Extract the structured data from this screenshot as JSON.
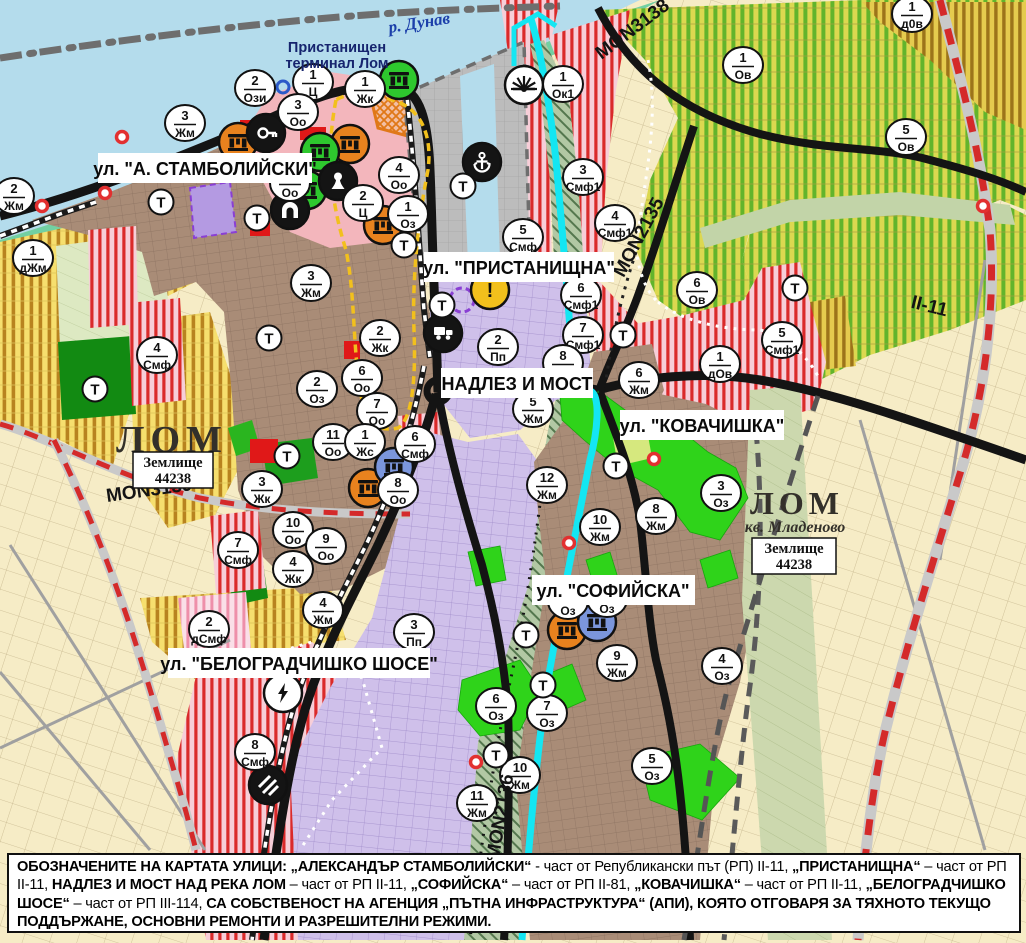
{
  "map": {
    "labels": {
      "river": "р. Дунав",
      "terminal_line1": "Пристанищен",
      "terminal_line2": "терминал Лом",
      "street_stamboliyski": "ул. \"А. СТАМБОЛИЙСКИ\"",
      "street_pristanishtna": "ул. \"ПРИСТАНИЩНА\"",
      "nadlez": "НАДЛЕЗ И МОСТ",
      "street_kovachishka": "ул. \"КОВАЧИШКА\"",
      "street_sofiyska": "ул. \"СОФИЙСКА\"",
      "street_belogradchishko": "ул. \"БЕЛОГРАДЧИШКО ШОСЕ\"",
      "town_west": "ЛОМ",
      "town_east": "ЛОМ",
      "district_east": "кв. Младеново",
      "landplot_line1": "Землище",
      "landplot_line2": "44238",
      "road_mon3138": "MON3138",
      "road_mon2135": "MON2135",
      "road_mon3139": "MON3139",
      "road_mon2136": "MON2136",
      "road_ii11": "II-11"
    },
    "colors": {
      "water": "#b4dcec",
      "shore_green": "#72d0a2",
      "town_brown": "#a98c77",
      "cream": "#f6ecc6",
      "zone_red_stripe": "#da2a2a",
      "vineyard_green": "#62b42c",
      "yellow_zone": "#f6df6e",
      "purple_zone": "#cfc0ea",
      "port_gray": "#bcbcbc",
      "river_cyan": "#14e6f2",
      "road_black": "#141414",
      "road_red_dash": "#d42a2a",
      "marker_fill": "#ffffff",
      "marker_stroke": "#111111",
      "ruins_orange": "#e8821e",
      "ruins_green": "#2ec82e",
      "ruins_blue": "#7b96dc",
      "warn_yellow": "#f2c01c",
      "bright_green": "#2fd31a",
      "dark_green": "#128a12"
    },
    "zone_markers": [
      {
        "x": 14,
        "y": 196,
        "num": "2",
        "code": "Жм"
      },
      {
        "x": 33,
        "y": 258,
        "num": "1",
        "code": "дЖм"
      },
      {
        "x": 185,
        "y": 123,
        "num": "3",
        "code": "Жм"
      },
      {
        "x": 255,
        "y": 88,
        "num": "2",
        "code": "Ози"
      },
      {
        "x": 313,
        "y": 82,
        "num": "1",
        "code": "Ц"
      },
      {
        "x": 298,
        "y": 112,
        "num": "3",
        "code": "Оо"
      },
      {
        "x": 365,
        "y": 89,
        "num": "1",
        "code": "Жк"
      },
      {
        "x": 399,
        "y": 175,
        "num": "4",
        "code": "Оо"
      },
      {
        "x": 363,
        "y": 203,
        "num": "2",
        "code": "Ц"
      },
      {
        "x": 408,
        "y": 214,
        "num": "1",
        "code": "Оз"
      },
      {
        "x": 290,
        "y": 183,
        "num": "",
        "code": "Оо"
      },
      {
        "x": 311,
        "y": 283,
        "num": "3",
        "code": "Жм"
      },
      {
        "x": 380,
        "y": 338,
        "num": "2",
        "code": "Жк"
      },
      {
        "x": 317,
        "y": 389,
        "num": "2",
        "code": "Оз"
      },
      {
        "x": 362,
        "y": 378,
        "num": "6",
        "code": "Оо"
      },
      {
        "x": 377,
        "y": 411,
        "num": "7",
        "code": "Оо"
      },
      {
        "x": 333,
        "y": 442,
        "num": "11",
        "code": "Оо"
      },
      {
        "x": 365,
        "y": 442,
        "num": "1",
        "code": "Жс"
      },
      {
        "x": 415,
        "y": 444,
        "num": "6",
        "code": "Смф"
      },
      {
        "x": 398,
        "y": 490,
        "num": "8",
        "code": "Оо"
      },
      {
        "x": 293,
        "y": 530,
        "num": "10",
        "code": "Оо"
      },
      {
        "x": 326,
        "y": 546,
        "num": "9",
        "code": "Оо"
      },
      {
        "x": 293,
        "y": 569,
        "num": "4",
        "code": "Жк"
      },
      {
        "x": 262,
        "y": 489,
        "num": "3",
        "code": "Жк"
      },
      {
        "x": 238,
        "y": 550,
        "num": "7",
        "code": "Смф"
      },
      {
        "x": 157,
        "y": 355,
        "num": "4",
        "code": "Смф"
      },
      {
        "x": 523,
        "y": 237,
        "num": "5",
        "code": "Смф"
      },
      {
        "x": 563,
        "y": 84,
        "num": "1",
        "code": "Ок1"
      },
      {
        "x": 583,
        "y": 177,
        "num": "3",
        "code": "Смф1"
      },
      {
        "x": 615,
        "y": 223,
        "num": "4",
        "code": "Смф1"
      },
      {
        "x": 581,
        "y": 295,
        "num": "6",
        "code": "Смф1"
      },
      {
        "x": 583,
        "y": 335,
        "num": "7",
        "code": "Смф1"
      },
      {
        "x": 743,
        "y": 65,
        "num": "1",
        "code": "Ов"
      },
      {
        "x": 912,
        "y": 14,
        "num": "1",
        "code": "д0в"
      },
      {
        "x": 906,
        "y": 137,
        "num": "5",
        "code": "Ов"
      },
      {
        "x": 697,
        "y": 290,
        "num": "6",
        "code": "Ов"
      },
      {
        "x": 720,
        "y": 364,
        "num": "1",
        "code": "дОв"
      },
      {
        "x": 782,
        "y": 340,
        "num": "5",
        "code": "Смф1"
      },
      {
        "x": 639,
        "y": 380,
        "num": "6",
        "code": "Жм"
      },
      {
        "x": 563,
        "y": 363,
        "num": "8",
        "code": ""
      },
      {
        "x": 533,
        "y": 409,
        "num": "5",
        "code": "Жм"
      },
      {
        "x": 547,
        "y": 485,
        "num": "12",
        "code": "Жм"
      },
      {
        "x": 600,
        "y": 527,
        "num": "10",
        "code": "Жм"
      },
      {
        "x": 656,
        "y": 516,
        "num": "8",
        "code": "Жм"
      },
      {
        "x": 721,
        "y": 493,
        "num": "3",
        "code": "Оз"
      },
      {
        "x": 498,
        "y": 347,
        "num": "2",
        "code": "Пп"
      },
      {
        "x": 568,
        "y": 601,
        "num": "",
        "code": "Оз"
      },
      {
        "x": 607,
        "y": 599,
        "num": "",
        "code": "Оз"
      },
      {
        "x": 617,
        "y": 663,
        "num": "9",
        "code": "Жм"
      },
      {
        "x": 722,
        "y": 666,
        "num": "4",
        "code": "Оз"
      },
      {
        "x": 496,
        "y": 706,
        "num": "6",
        "code": "Оз"
      },
      {
        "x": 547,
        "y": 713,
        "num": "7",
        "code": "Оз"
      },
      {
        "x": 652,
        "y": 766,
        "num": "5",
        "code": "Оз"
      },
      {
        "x": 520,
        "y": 775,
        "num": "10",
        "code": "Жм"
      },
      {
        "x": 477,
        "y": 803,
        "num": "11",
        "code": "Жм"
      },
      {
        "x": 209,
        "y": 629,
        "num": "2",
        "code": "дСмф"
      },
      {
        "x": 323,
        "y": 610,
        "num": "4",
        "code": "Жм"
      },
      {
        "x": 414,
        "y": 632,
        "num": "3",
        "code": "Пп"
      },
      {
        "x": 255,
        "y": 752,
        "num": "8",
        "code": "Смф"
      }
    ],
    "t_label": "Т",
    "t_markers": [
      {
        "x": 161,
        "y": 202
      },
      {
        "x": 257,
        "y": 218
      },
      {
        "x": 404,
        "y": 245
      },
      {
        "x": 442,
        "y": 305
      },
      {
        "x": 463,
        "y": 186
      },
      {
        "x": 95,
        "y": 389
      },
      {
        "x": 269,
        "y": 338
      },
      {
        "x": 287,
        "y": 456
      },
      {
        "x": 623,
        "y": 335
      },
      {
        "x": 795,
        "y": 288
      },
      {
        "x": 616,
        "y": 466
      },
      {
        "x": 526,
        "y": 635
      },
      {
        "x": 543,
        "y": 685
      },
      {
        "x": 496,
        "y": 755
      }
    ],
    "icons": [
      {
        "x": 238,
        "y": 142,
        "type": "ruins",
        "fill": "#e8821e",
        "name": "cultural-monument-orange-icon"
      },
      {
        "x": 350,
        "y": 144,
        "type": "ruins",
        "fill": "#e8821e",
        "name": "cultural-monument-orange-icon"
      },
      {
        "x": 383,
        "y": 225,
        "type": "ruins",
        "fill": "#e8821e",
        "name": "cultural-monument-orange-icon"
      },
      {
        "x": 368,
        "y": 488,
        "type": "ruins",
        "fill": "#e8821e",
        "name": "cultural-monument-orange-icon"
      },
      {
        "x": 567,
        "y": 630,
        "type": "ruins",
        "fill": "#e8821e",
        "name": "cultural-monument-orange-icon"
      },
      {
        "x": 320,
        "y": 152,
        "type": "ruins",
        "fill": "#2ec82e",
        "name": "cultural-monument-green-icon"
      },
      {
        "x": 399,
        "y": 80,
        "type": "ruins",
        "fill": "#2ec82e",
        "name": "cultural-monument-green-icon"
      },
      {
        "x": 307,
        "y": 190,
        "type": "ruins",
        "fill": "#2ec82e",
        "name": "cultural-monument-green-icon"
      },
      {
        "x": 394,
        "y": 467,
        "type": "ruins",
        "fill": "#7b96dc",
        "name": "cultural-monument-blue-icon"
      },
      {
        "x": 597,
        "y": 622,
        "type": "ruins",
        "fill": "#7b96dc",
        "name": "cultural-monument-blue-icon"
      },
      {
        "x": 266,
        "y": 133,
        "type": "key",
        "fill": "#141414",
        "name": "key-site-icon"
      },
      {
        "x": 338,
        "y": 181,
        "type": "pawn",
        "fill": "#141414",
        "name": "monument-figure-icon"
      },
      {
        "x": 290,
        "y": 210,
        "type": "arch",
        "fill": "#141414",
        "name": "arch-monument-icon"
      },
      {
        "x": 482,
        "y": 162,
        "type": "anchor",
        "fill": "#141414",
        "name": "port-anchor-icon"
      },
      {
        "x": 524,
        "y": 85,
        "type": "sun",
        "fill": "#ffffff",
        "name": "sunrise-icon"
      },
      {
        "x": 443,
        "y": 333,
        "type": "truck",
        "fill": "#141414",
        "name": "freight-station-icon"
      },
      {
        "x": 283,
        "y": 693,
        "type": "bolt",
        "fill": "#ffffff",
        "name": "power-substation-icon"
      },
      {
        "x": 268,
        "y": 785,
        "type": "railx",
        "fill": "#141414",
        "name": "rail-crossing-icon"
      },
      {
        "x": 490,
        "y": 290,
        "type": "warn",
        "fill": "#f2c01c",
        "name": "warning-icon"
      }
    ],
    "poi_dots": [
      {
        "x": 122,
        "y": 137
      },
      {
        "x": 105,
        "y": 193
      },
      {
        "x": 42,
        "y": 206
      },
      {
        "x": 569,
        "y": 543
      },
      {
        "x": 654,
        "y": 459
      },
      {
        "x": 476,
        "y": 762
      },
      {
        "x": 983,
        "y": 206
      }
    ],
    "blue_ring": {
      "x": 283,
      "y": 87
    }
  },
  "footer": {
    "runs": [
      {
        "t": "ОБОЗНАЧЕНИТЕ НА КАРТАТА УЛИЦИ: „АЛЕКСАНДЪР СТАМБОЛИЙСКИ“",
        "b": true
      },
      {
        "t": " - част от Републикански път (РП) II-11, ",
        "b": false
      },
      {
        "t": "„ПРИСТАНИЩНА“",
        "b": true
      },
      {
        "t": " – част от РП II-11, ",
        "b": false
      },
      {
        "t": "НАДЛЕЗ И МОСТ НАД РЕКА ЛОМ",
        "b": true
      },
      {
        "t": " – част от РП II-11, ",
        "b": false
      },
      {
        "t": "„СОФИЙСКА“",
        "b": true
      },
      {
        "t": " – част от РП II-81, ",
        "b": false
      },
      {
        "t": "„КОВАЧИШКА“",
        "b": true
      },
      {
        "t": " – част от РП II-11, ",
        "b": false
      },
      {
        "t": "„БЕЛОГРАДЧИШКО ШОСЕ“",
        "b": true
      },
      {
        "t": " – част от РП III-114, ",
        "b": false
      },
      {
        "t": "СА СОБСТВЕНОСТ НА АГЕНЦИЯ „ПЪТНА ИНФРАСТРУКТУРА“ (АПИ), КОЯТО ОТГОВАРЯ ЗА ТЯХНОТО ТЕКУЩО ПОДДЪРЖАНЕ, ОСНОВНИ РЕМОНТИ И РАЗРЕШИТЕЛНИ РЕЖИМИ.",
        "b": true
      }
    ]
  }
}
